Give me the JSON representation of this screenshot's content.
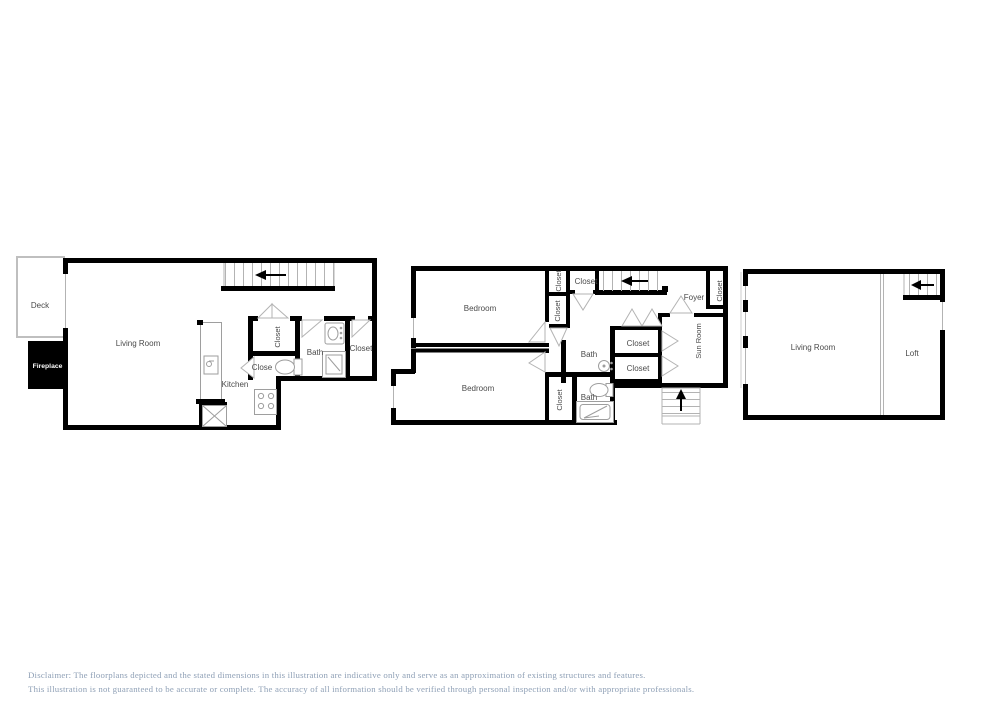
{
  "floor1": {
    "deck": "Deck",
    "fireplace": "Fireplace",
    "living_room": "Living Room",
    "kitchen": "Kitchen",
    "closet_hall": "Closet",
    "closet_small": "Close",
    "bath": "Bath",
    "closet_right": "Closet"
  },
  "floor2": {
    "bedroom_top": "Bedroom",
    "bedroom_bottom": "Bedroom",
    "closet_a": "Closet",
    "closet_b": "Closet",
    "closet_top": "Closet",
    "foyer": "Foyer",
    "closet_foyer": "Closet",
    "bath_top": "Bath",
    "closet_mid_top": "Closet",
    "closet_mid_bottom": "Closet",
    "sun_room": "Sun Room",
    "closet_bedroom2": "Closet",
    "bath_bottom": "Bath"
  },
  "floor3": {
    "living_room": "Living Room",
    "loft": "Loft"
  },
  "disclaimer": {
    "line1": "Disclaimer: The floorplans depicted and the stated dimensions in this illustration are indicative only and serve as an approximation of existing structures and features.",
    "line2": "This illustration is not guaranteed to be accurate or complete. The accuracy of all information should be verified through personal inspection and/or with appropriate professionals."
  },
  "colors": {
    "wall": "#000000",
    "thin_line": "#9e9e9e",
    "tread_line": "#b3b3b3",
    "label": "#4a4a4a",
    "disclaimer_text": "#8fa0b6",
    "deck_outline": "#bfbfbf",
    "fireplace_fill": "#000000"
  }
}
